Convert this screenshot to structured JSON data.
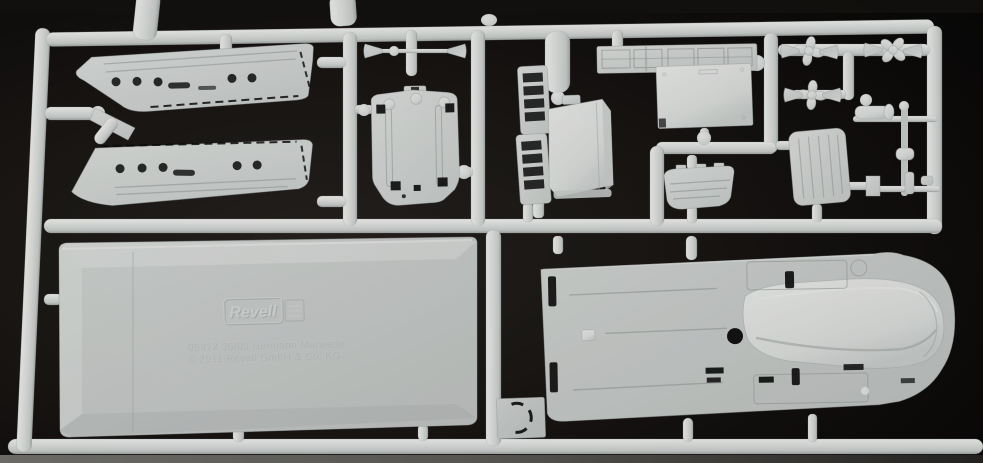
{
  "scene": {
    "description": "Photograph of a white injection-moulded plastic model kit sprue (parts tree) lying on a black background",
    "embossed_brand": "Revell",
    "embossed_line1": "05812 36/00 Hermann Marwede",
    "embossed_line2": "© 2011 Revell GmbH & Co. KG"
  },
  "colors": {
    "bg-core": "#272320",
    "bg-mid": "#14110f",
    "bg-edge": "#040404",
    "top-strip": "#141210",
    "floor-a": "#8a8984",
    "floor-b": "#6c6b66",
    "floor-c": "#2b2a28",
    "plastic-hi": "#f5f7f5",
    "plastic": "#e6e9e7",
    "plastic-mid": "#d2d7d5",
    "plastic-sh": "#aab0ae",
    "panel-a": "#d8dcda",
    "panel-b": "#c6cbc9",
    "line": "#9aa19f",
    "hole": "#0a0a0a",
    "emboss-dark": "#b2b8b6",
    "emboss-lite": "#dfe4e2"
  },
  "parts": [
    {
      "name": "hull-half-port",
      "desc": "ship hull half, porthole row, dashed deck edge"
    },
    {
      "name": "hull-half-starboard",
      "desc": "mirrored ship hull half"
    },
    {
      "name": "bow-connector",
      "desc": "angled runner elbow and keel sliver at the bows"
    },
    {
      "name": "deck-plate-part",
      "desc": "small deck plate with twin ribs and corner slots"
    },
    {
      "name": "tow-rod-assembly",
      "desc": "thin rod with two cone bosses"
    },
    {
      "name": "railing-ladder-a",
      "desc": "ladder-style railing frame"
    },
    {
      "name": "railing-ladder-b",
      "desc": "ladder-style railing frame"
    },
    {
      "name": "wheelhouse-box",
      "desc": "bright box-shaped deckhouse"
    },
    {
      "name": "hatch-grating-strip",
      "desc": "flat strip with scribed hatch rectangles"
    },
    {
      "name": "superstructure-panel",
      "desc": "large bright rectangular panel"
    },
    {
      "name": "dinghy-hull",
      "desc": "small boat hull with plank lines"
    },
    {
      "name": "louvred-hatch-panel",
      "desc": "rounded panel with vertical grooves"
    },
    {
      "name": "propeller-a"
    },
    {
      "name": "propeller-b"
    },
    {
      "name": "propeller-c"
    },
    {
      "name": "shaft-cones",
      "count": 6
    },
    {
      "name": "mast-and-fittings",
      "desc": "mast, winch drum and thin fitting rods"
    },
    {
      "name": "pontoon-base-plate",
      "desc": "large bevelled base plate with embossed Revell logo and mould text"
    },
    {
      "name": "main-deck-with-fairing",
      "desc": "large deck with raised boat-shaped fairing, slots and scribed panels"
    },
    {
      "name": "engraved-circle-plate",
      "desc": "small square plate with dashed engraved circle"
    }
  ]
}
